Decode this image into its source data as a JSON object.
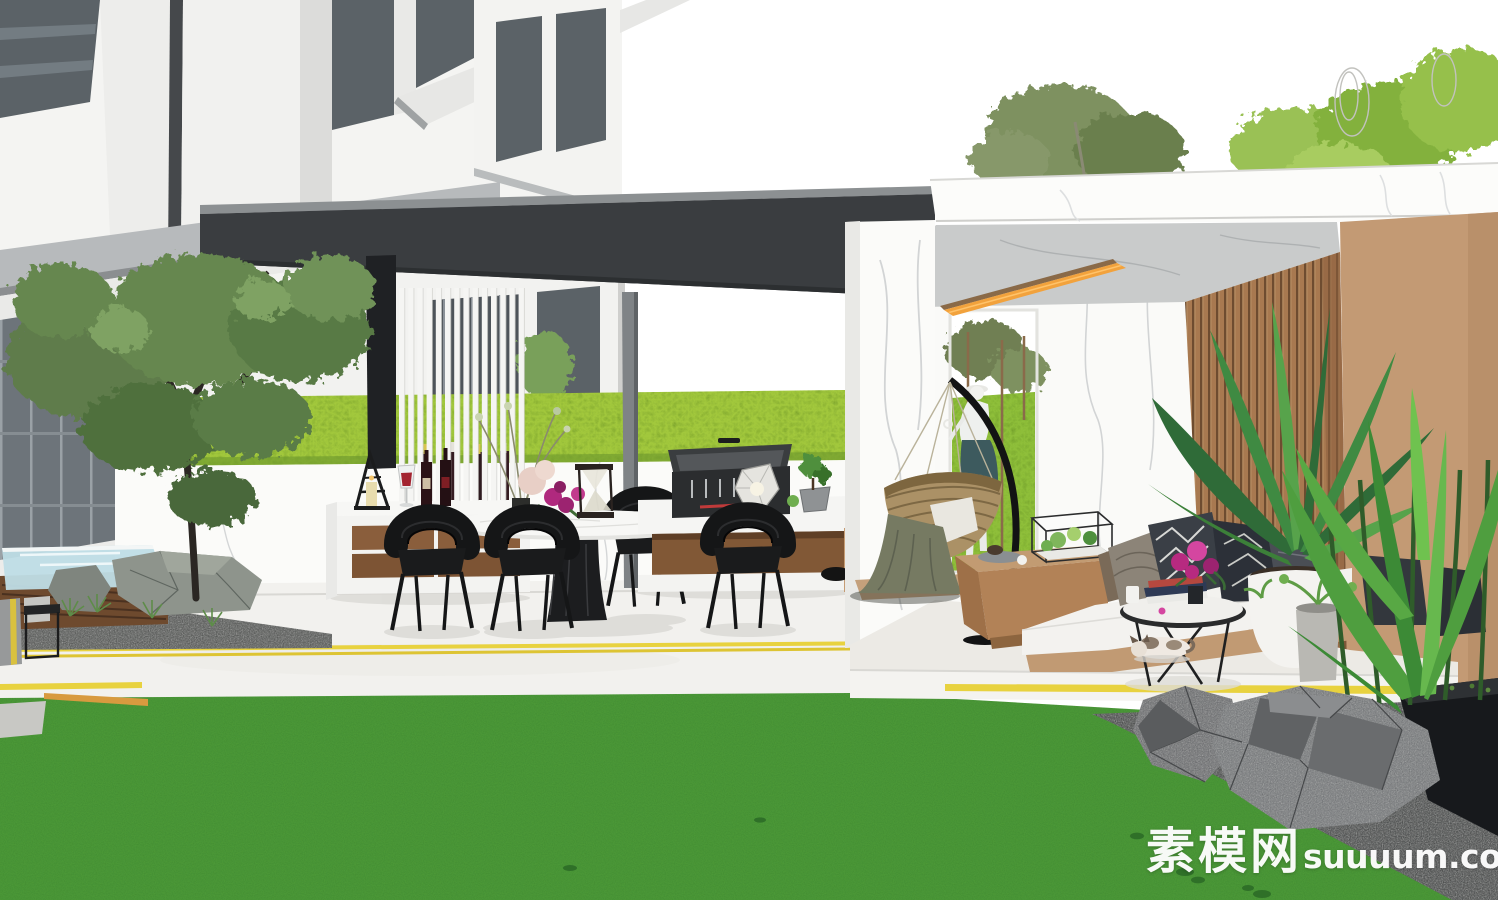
{
  "canvas": {
    "width": 1498,
    "height": 900
  },
  "image": {
    "type": "3d-architectural-render",
    "subject": "Modern residential courtyard with cantilever pergola outdoor dining area and marble pavilion lounge"
  },
  "watermark": {
    "site_name_cn": "素模网",
    "site_domain": "suuuum.com"
  },
  "palette": {
    "sky_white": "#ffffff",
    "lawn_green": "#4f9e3b",
    "hedge_green": "#a2c83e",
    "canopy_charcoal": "#3a3d40",
    "accent_yellow": "#e8d23f",
    "accent_orange_light": "#f2a23c",
    "wood_slat_brown": "#a87950",
    "wall_tan": "#c39a74",
    "marble_white": "#fbfbf9",
    "chair_black": "#151617",
    "counter_wood": "#815836",
    "flower_magenta": "#b72a80",
    "wine_red": "#a32430",
    "glass_blue": "#bfdde6",
    "rock_gray": "#77797b",
    "steel_gray": "#7f8386"
  },
  "scene_objects": [
    "apartment building facade",
    "courtyard maple tree",
    "charcoal cantilever pergola canopy",
    "white vertical louver screen with wine rack",
    "outdoor bar counter with lantern, wine glass and bottles",
    "round marble dining table with flowers and hourglass",
    "black rattan dining chairs",
    "bbq grill station with faceted lamp and bonsai",
    "green hedge wall",
    "marble pool pavilion with amber recessed ceiling light",
    "hanging rattan egg chair with olive blanket",
    "garden statue in wall opening",
    "walnut slat feature wall",
    "outdoor bench sofa with patterned cushions",
    "timber coffee table with plant terrarium",
    "black round side table with books and magenta flowers",
    "sleeping cat",
    "potted palm in white planter",
    "traveler palm in black planter",
    "faceted landscape rocks on gravel",
    "glass water feature on timber base",
    "lawn with yellow inlay strips"
  ]
}
